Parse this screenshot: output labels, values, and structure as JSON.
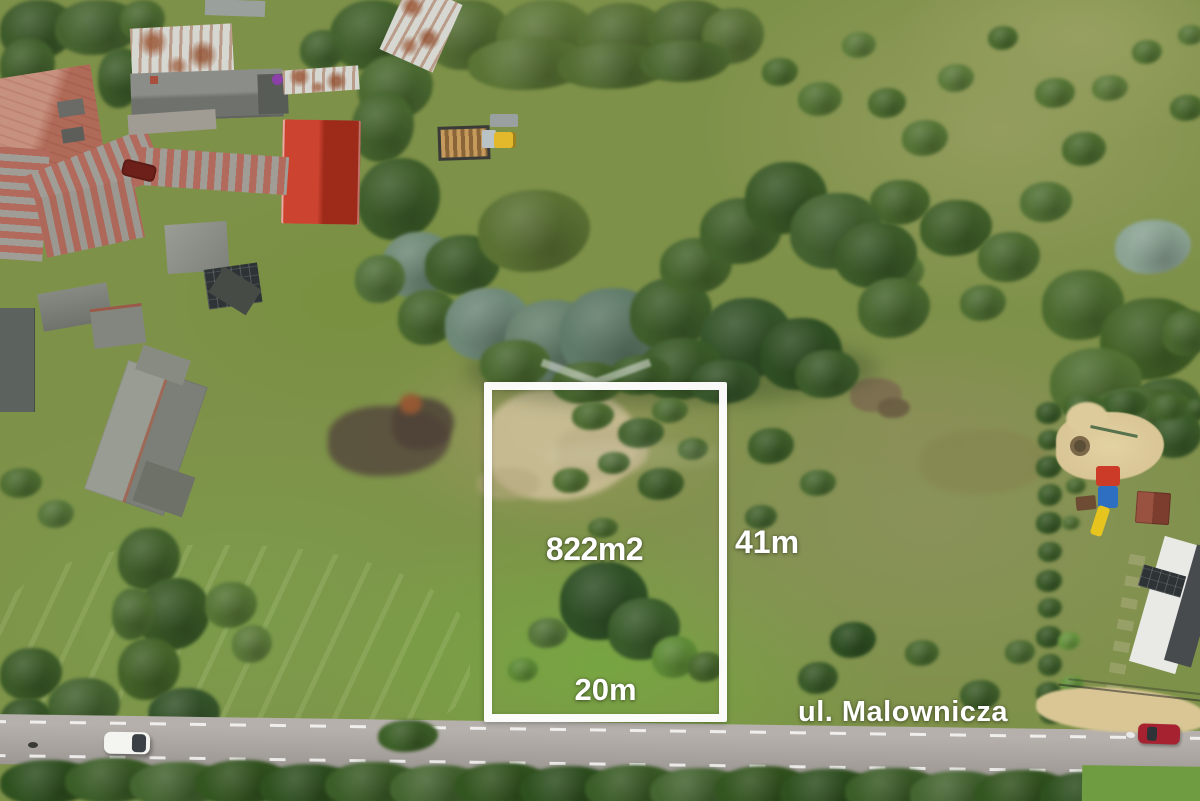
{
  "overlay": {
    "plot": {
      "area_label": "822m2",
      "right_side_label": "41m",
      "bottom_side_label": "20m",
      "outline_color": "#ffffff"
    },
    "street_label": "ul. Malownicza",
    "label_color": "#ffffff"
  },
  "palette": {
    "plot_outline": "#ffffff",
    "label_text": "#ffffff",
    "road": "#a9a49f",
    "white_car": "#f2f2ef",
    "red_car": "#a62230"
  }
}
